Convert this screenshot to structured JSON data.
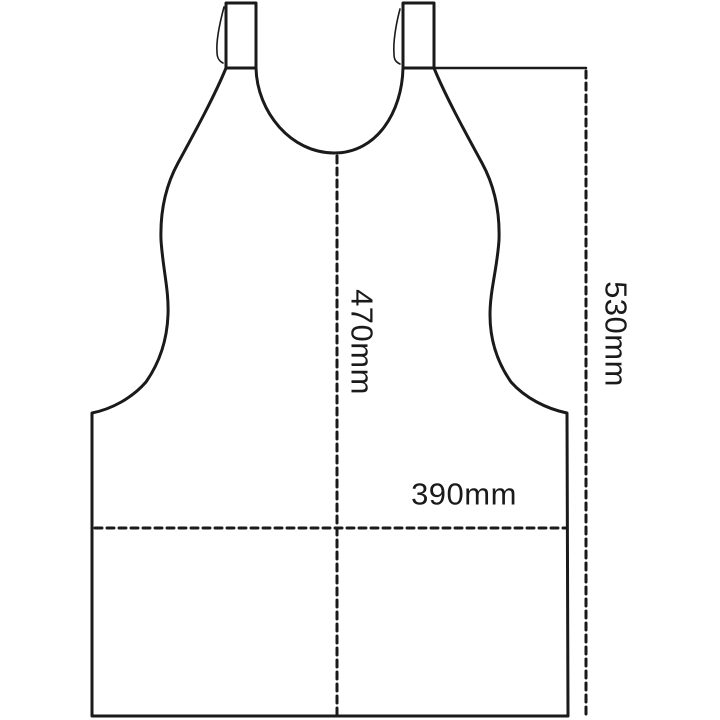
{
  "diagram": {
    "name": "apron-dimension-diagram",
    "subject": "bib apron outline drawing with dimension lines",
    "colors": {
      "line": "#1a1a1a",
      "background": "#ffffff",
      "text": "#1a1a1a"
    },
    "measurements": {
      "bib_height": {
        "label": "470mm",
        "orientation": "vertical"
      },
      "total_height": {
        "label": "530mm",
        "orientation": "vertical"
      },
      "width": {
        "label": "390mm",
        "orientation": "horizontal"
      }
    }
  }
}
